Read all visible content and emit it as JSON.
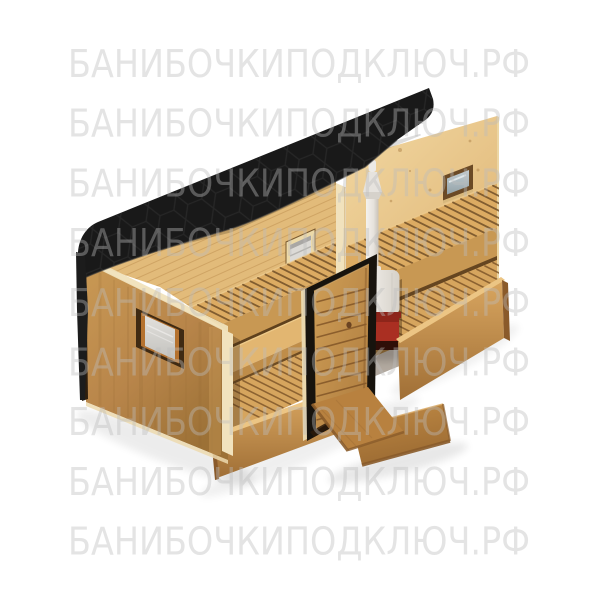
{
  "watermark": {
    "text": "БАНИБОЧКИПОДКЛЮЧ.РФ",
    "rows": 9,
    "color": "#bdbdbd",
    "opacity": 0.4,
    "font_size": 38,
    "x": 68,
    "text_length": 462,
    "first_baseline": 77,
    "row_spacing": 59.7
  },
  "scene": {
    "subject": "wooden mobile sauna cabin — isometric cutaway 3D render",
    "style": "product visualization on white background",
    "parts": [
      "black-roof",
      "left-end-wall",
      "left-wall-window",
      "interior-benches",
      "washroom-window",
      "sauna-room",
      "sauna-window",
      "stove-with-chimney",
      "entrance-door",
      "access-ramp"
    ],
    "colors": {
      "roof": "#191919",
      "hex_line": "#343434",
      "roof_trim": "#2e1e0d",
      "wall_light": "#c99954",
      "wall_dark": "#9c7136",
      "wall_streak": "#8f6530",
      "cream": "#f1e2bd",
      "back_wall": "#e2bb7a",
      "back_wall_line": "#c09253",
      "bench": "#dcab62",
      "bench_face": "#c89853",
      "slat_gap": "#6b4a24",
      "landing": "#e2b671",
      "step_face": "#bf8d49",
      "floor": "#d6a55e",
      "floor_gap": "#7a5226",
      "slot": "#4c3114",
      "bort_light": "#d9a660",
      "bort_dark": "#a06f36",
      "bort_top": "#ecc584",
      "bort_end": "#8a5a2a",
      "right_wall_light": "#f2d8a2",
      "right_wall_dark": "#ddb271",
      "knot": "#b08349",
      "door_light": "#cf9e56",
      "door_dark": "#ae7c3f",
      "door_line": "#7e5225",
      "frame_black": "#17130d",
      "jamb": "#e9d7ad",
      "ramp_light": "#c08a45",
      "ramp_dark": "#9d6c33",
      "ramp_edge": "#8a5c2b",
      "stove_white": "#f6f4f0",
      "stove_shade": "#d6d1c9",
      "stove_red": "#aa2f22",
      "stove_red_dark": "#7c1f15",
      "stove_band": "#2f0e08",
      "win_frame_dark": "#3f2a13",
      "win_frame_orange": "#b5722f",
      "glass_light": "#dcdad6",
      "glass_cool": "#b7c3c6",
      "w2_frame": "#6b4a26",
      "shadow": "#000000"
    }
  }
}
